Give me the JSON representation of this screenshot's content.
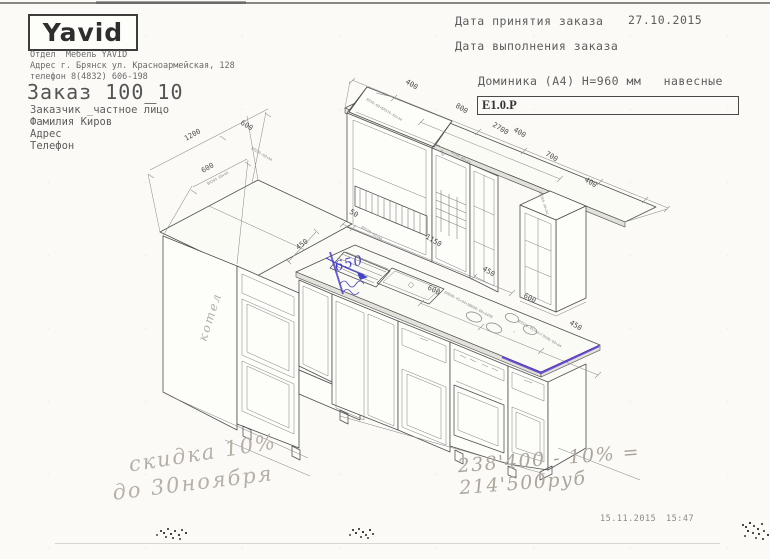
{
  "document": {
    "logo": "Yavid",
    "header": {
      "company_lines": [
        "Отдел  Мебель YAVID",
        "Адрес г. Брянск ул. Красноармейская, 128",
        "телефон 8(4832) 606-198"
      ],
      "order_title": "Заказ 100_10",
      "customer_lines": [
        "Заказчик _частное лицо",
        "Фамилия Киров",
        "Адрес",
        "Телефон"
      ],
      "date_accepted_label": "Дата принятия заказа",
      "date_accepted_value": "27.10.2015",
      "date_done_label": "Дата выполнения заказа",
      "model_title": "Доминика (А4) Н=960 мм   навесные",
      "spec_code": "Е1.0.Р"
    },
    "drawing": {
      "dim_labels": [
        {
          "t": "1200",
          "x": 186,
          "y": 141,
          "r": -29
        },
        {
          "t": "600",
          "x": 240,
          "y": 124,
          "r": 31
        },
        {
          "t": "600",
          "x": 203,
          "y": 173,
          "r": -29
        },
        {
          "t": "400",
          "x": 405,
          "y": 83,
          "r": 31
        },
        {
          "t": "800",
          "x": 455,
          "y": 107,
          "r": 31
        },
        {
          "t": "2700",
          "x": 492,
          "y": 126,
          "r": 31
        },
        {
          "t": "400",
          "x": 513,
          "y": 131,
          "r": 31
        },
        {
          "t": "700",
          "x": 545,
          "y": 155,
          "r": 31
        },
        {
          "t": "400",
          "x": 584,
          "y": 181,
          "r": 31
        },
        {
          "t": "50",
          "x": 349,
          "y": 213,
          "r": 31
        },
        {
          "t": "1150",
          "x": 425,
          "y": 238,
          "r": 31
        },
        {
          "t": "450",
          "x": 482,
          "y": 270,
          "r": 31
        },
        {
          "t": "450",
          "x": 298,
          "y": 250,
          "r": -36
        },
        {
          "t": "600",
          "x": 427,
          "y": 289,
          "r": 28
        },
        {
          "t": "600",
          "x": 523,
          "y": 297,
          "r": 28
        },
        {
          "t": "450",
          "x": 569,
          "y": 324,
          "r": 31
        }
      ],
      "code_labels": [
        {
          "t": "ВЛ38-60+ВЛ376-60+44",
          "x": 366,
          "y": 100,
          "r": 31
        },
        {
          "t": "300",
          "x": 440,
          "y": 150,
          "r": 72
        },
        {
          "t": "ВЛ38-40+44",
          "x": 451,
          "y": 153,
          "r": 31
        },
        {
          "t": "ВЛ300-40+44",
          "x": 539,
          "y": 192,
          "r": 72
        },
        {
          "t": "ВЛ295-60+А4",
          "x": 251,
          "y": 149,
          "r": 31
        },
        {
          "t": "ВЛ295-60+А4",
          "x": 208,
          "y": 185,
          "r": -29
        },
        {
          "t": "ВЛ229-60+А4",
          "x": 361,
          "y": 228,
          "r": 31
        },
        {
          "t": "ВЛ600-45+А4+ЛЮ600-60+А4РИ",
          "x": 444,
          "y": 293,
          "r": 28
        },
        {
          "t": "ВЛ500-45+А4+ГЛ500-60+А4",
          "x": 518,
          "y": 322,
          "r": 31
        },
        {
          "t": "!",
          "x": 513,
          "y": 333,
          "r": 0
        }
      ],
      "annotations": {
        "boiler": "котел",
        "sink_width": "650"
      }
    },
    "notes": {
      "discount_line1": "скидка 10%",
      "discount_line2": "до 30ноября",
      "price_line": "238'400 - 10% = 214'500руб"
    },
    "footer": {
      "print_date": "15.11.2015",
      "print_time": "15:47"
    }
  }
}
